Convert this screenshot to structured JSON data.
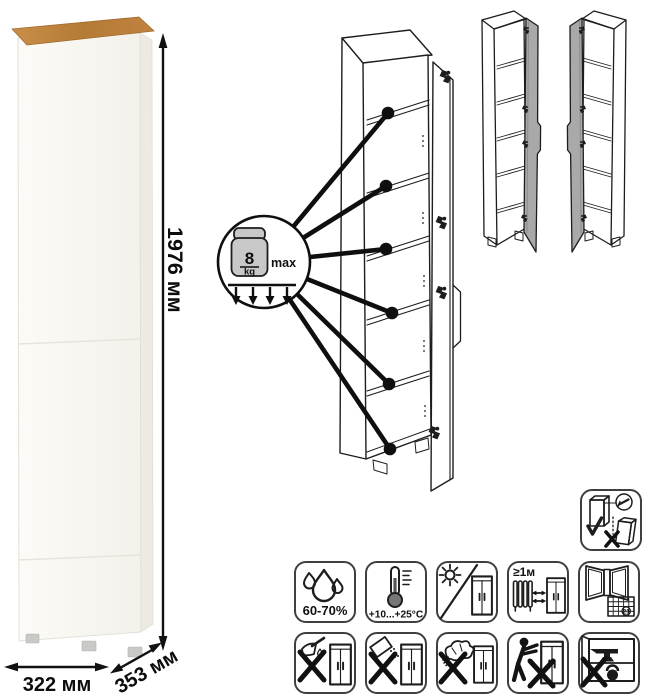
{
  "dimensions": {
    "height": "1976 мм",
    "width": "322 мм",
    "depth": "353 мм"
  },
  "shelf_load": {
    "value": "8",
    "unit": "kg",
    "qualifier": "max"
  },
  "care": {
    "humidity": "60-70%",
    "temperature": "+10...+25°C",
    "heat_distance": "≥1м",
    "calendar_day": "21"
  },
  "icon_legend": {
    "shelf_load": "weight-icon",
    "wall_anchor": "wall-anchor-icon",
    "humidity": "water-drops-icon",
    "temperature": "thermometer-icon",
    "sunlight": "no-direct-sunlight-icon",
    "heat_distance": "keep-distance-from-heat-icon",
    "ventilation": "ventilate-room-icon",
    "sharp_tools": "no-sharp-tools-icon",
    "abrasives": "no-abrasive-powder-icon",
    "wet_cleaning": "no-wet-cleaning-icon",
    "dragging": "no-dragging-icon",
    "overload": "no-overload-icon"
  },
  "colors": {
    "accent_wood": "#b97f3d",
    "line_art": "#1d1d1b",
    "door_gray": "#a9a9a9",
    "weight_gray": "#c8c8c8"
  }
}
